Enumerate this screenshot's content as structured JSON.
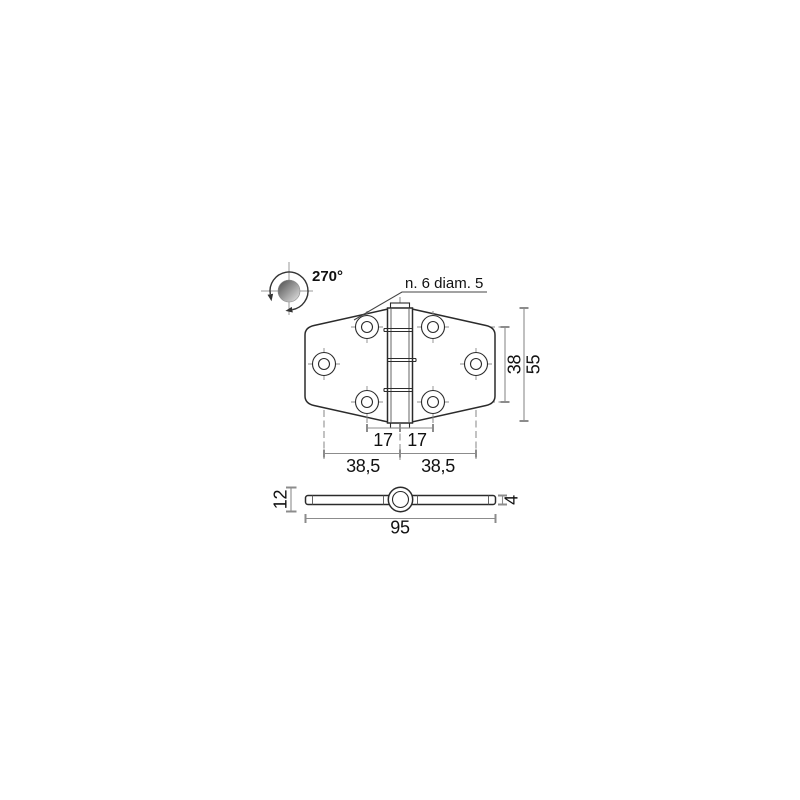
{
  "labels": {
    "rotation_angle": "270°",
    "hole_callout": "n. 6 diam. 5"
  },
  "dims": {
    "pitch_left": "17",
    "pitch_right": "17",
    "half_width_left": "38,5",
    "half_width_right": "38,5",
    "hole_row_spacing": "38",
    "overall_height": "55",
    "knuckle_od": "12",
    "leaf_thickness": "4",
    "overall_width": "95"
  },
  "colors": {
    "part_outline": "#2b2b2b",
    "dimension_line": "#8c8c8c",
    "text": "#111111",
    "ball_dark": "#4a4a4a",
    "ball_light": "#e8e8e8",
    "background": "#ffffff"
  }
}
